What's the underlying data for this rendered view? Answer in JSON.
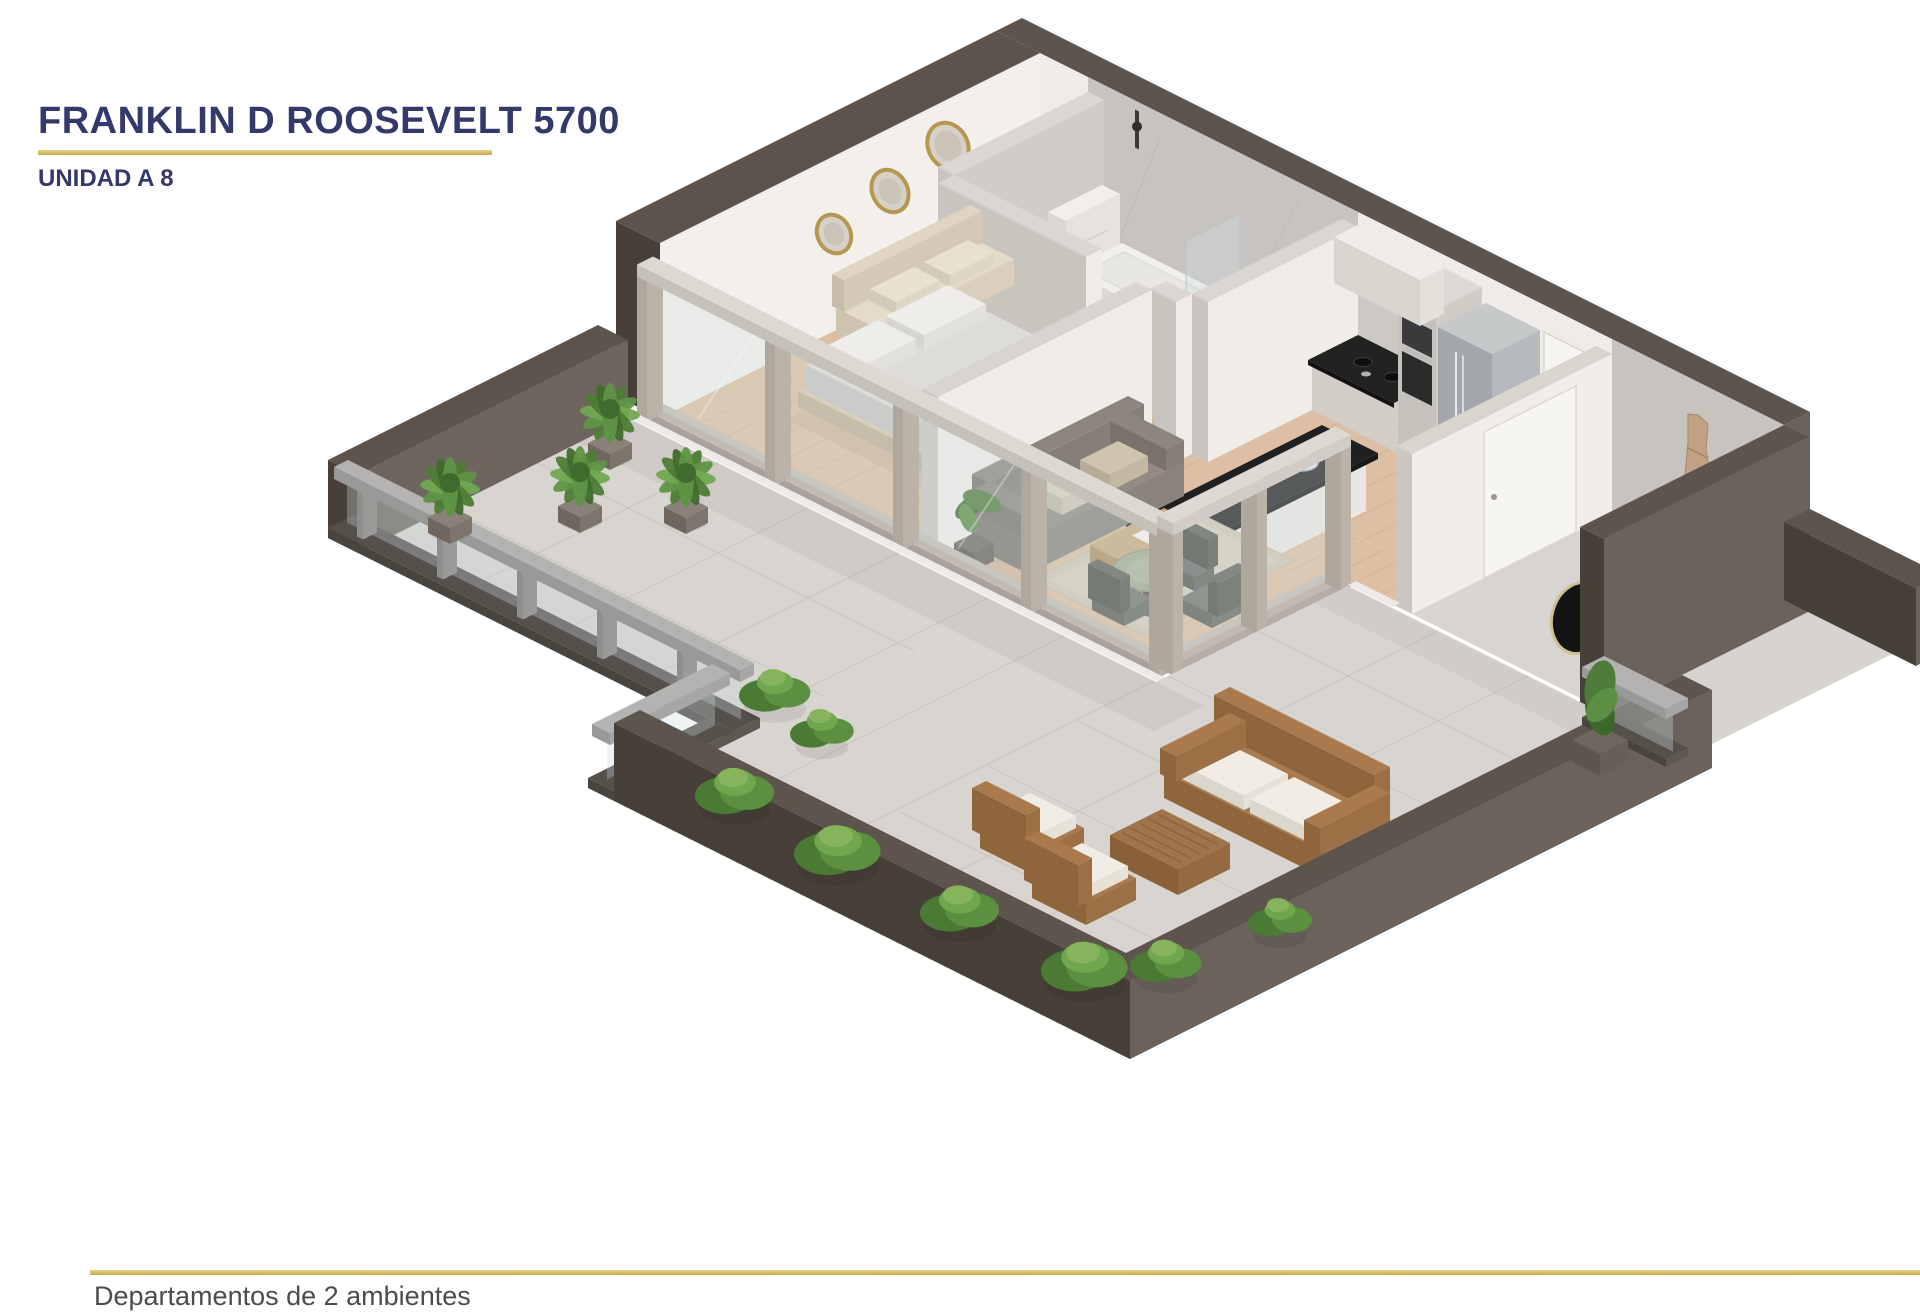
{
  "header": {
    "title": "FRANKLIN D ROOSEVELT 5700",
    "subtitle": "UNIDAD A 8"
  },
  "footer": {
    "caption": "Departamentos de 2 ambientes"
  },
  "colors": {
    "navy": "#333a6b",
    "gold": "#c9a84c",
    "gold_light": "#e6d185"
  }
}
